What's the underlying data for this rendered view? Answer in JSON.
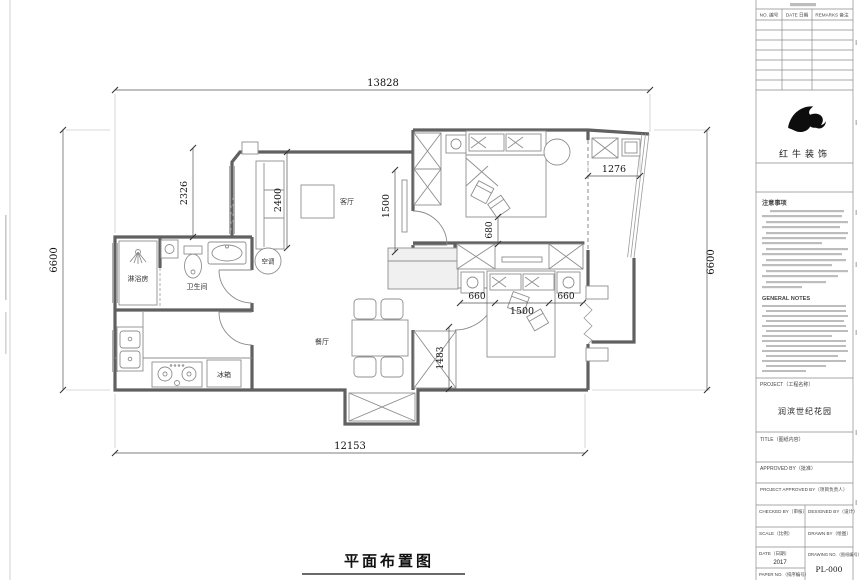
{
  "plan": {
    "footer_title": "平面布置图",
    "rooms": {
      "living": "客厅",
      "dining": "餐厅",
      "bathroom": "卫生间",
      "shower_room": "淋浴房",
      "fridge": "冰箱",
      "ac": "空调"
    },
    "dims": {
      "top": "13828",
      "bottom": "12153",
      "left": "6600",
      "right": "6600",
      "offset_left": "2326",
      "sofa": "2400",
      "tv_wall": "1500",
      "bed1_gap": "680",
      "balcony": "1276",
      "bed2_left": "660",
      "bed2_width": "1500",
      "bed2_right": "660",
      "bed2_side": "1483"
    }
  },
  "titleblock": {
    "company": "红牛装饰",
    "rev_table": {
      "col_no": "NO. 编号",
      "col_date": "DATE 日期",
      "col_remarks": "REMARKS 备注"
    },
    "notes_cn_title": "注意事项",
    "notes_en_title": "GENERAL NOTES",
    "project_label": "PROJECT（工程名称）",
    "project_name": "润滨世纪花园",
    "title_label": "TITLE（图纸内容）",
    "approved_label": "APPROVED BY（批准）",
    "project_approved_label": "PROJECT APPROVED BY（项目负责人）",
    "checked_label": "CHECKED BY（审核）",
    "designed_label": "DESIGNED BY（设计）",
    "scale_label": "SCALE（比例）",
    "drawn_label": "DRAWN BY（绘图）",
    "date_label": "DATE（日期）",
    "date_value": "2017",
    "drawing_no_label": "DRAWING NO.（图纸编号）",
    "drawing_no_value": "PL-000",
    "paper_label": "PAPER NO.（排序编号）"
  }
}
